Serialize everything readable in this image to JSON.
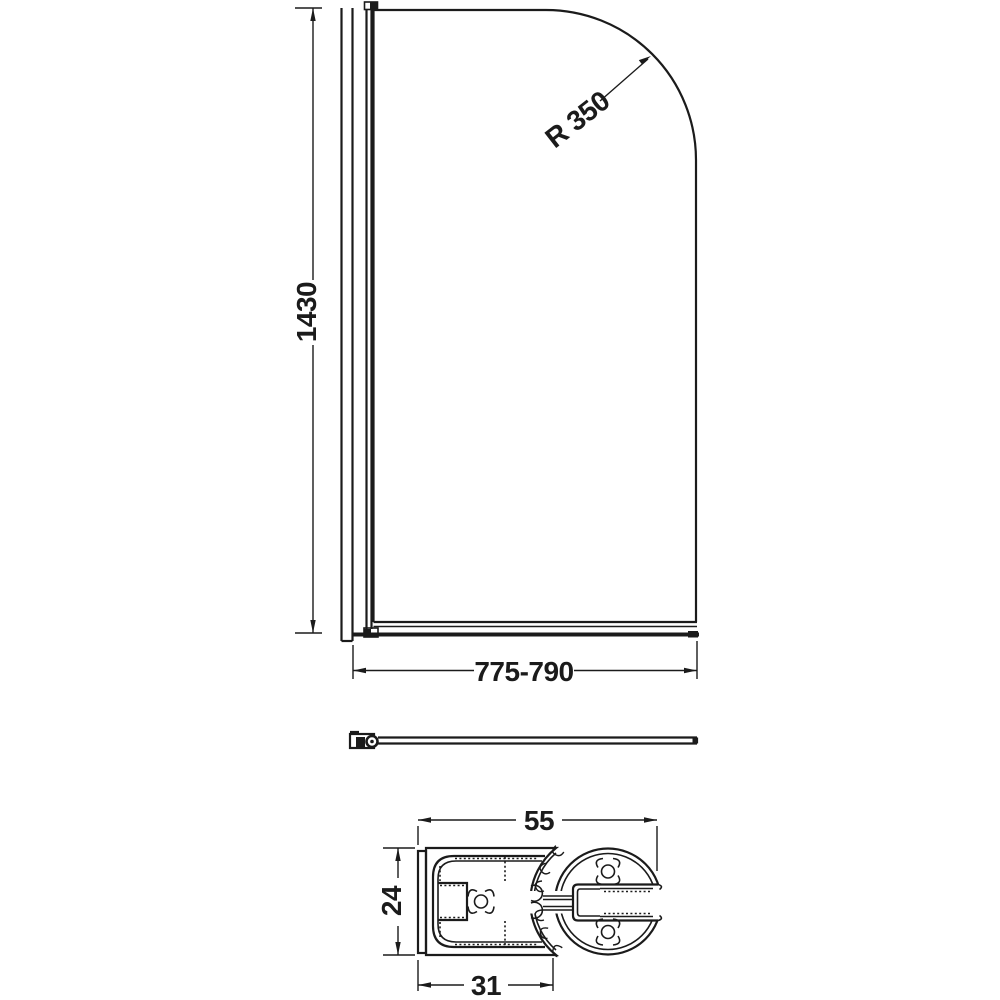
{
  "drawing": {
    "front_view": {
      "height_label": "1430",
      "radius_label": "R 350",
      "width_label": "775-790"
    },
    "section_view": {
      "overall_width_label": "55",
      "height_label": "24",
      "channel_width_label": "31"
    },
    "colors": {
      "line": "#1b1b1b",
      "background": "#ffffff"
    }
  }
}
